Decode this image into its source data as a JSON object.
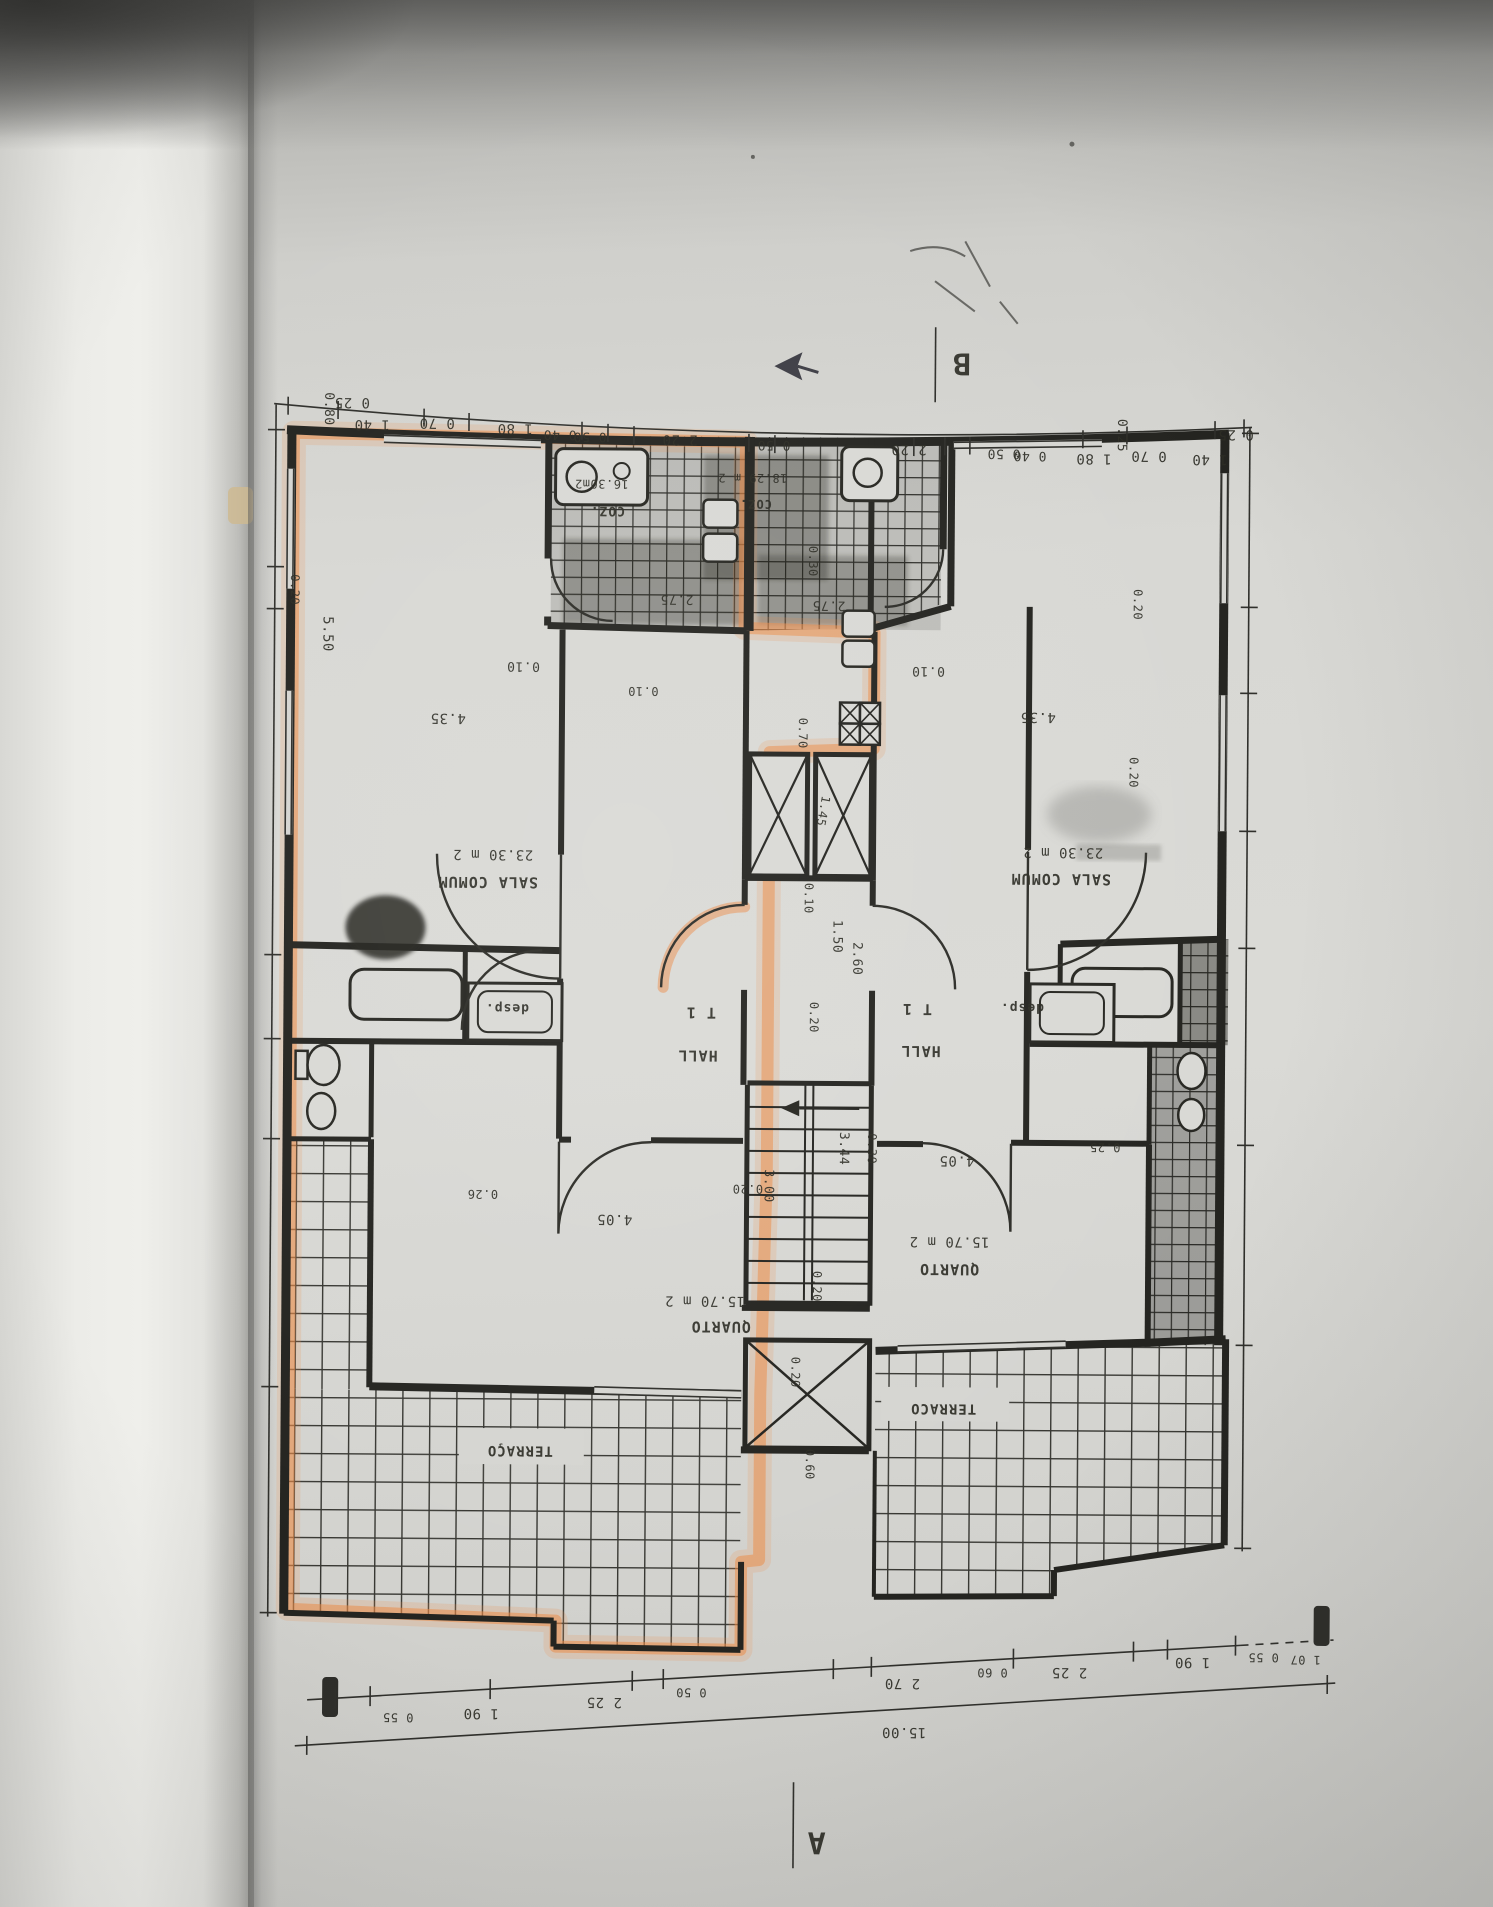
{
  "plan": {
    "section_markers": {
      "a": "A",
      "b": "B"
    },
    "highlight_color": "#ef8a43",
    "unit_left": {
      "highlighted": true,
      "type": "T 1",
      "rooms": [
        {
          "name": "SALA COMUM",
          "area": "23.30 m 2"
        },
        {
          "name": "QUARTO",
          "area": "15.70 m 2"
        },
        {
          "name": "HALL"
        },
        {
          "name": "desp."
        },
        {
          "name": "COZ.",
          "area": "16.30m2"
        },
        {
          "name": "TERRAÇO"
        }
      ]
    },
    "unit_right": {
      "highlighted": false,
      "type": "T 1",
      "rooms": [
        {
          "name": "SALA COMUM",
          "area": "23.30 m 2"
        },
        {
          "name": "QUARTO",
          "area": "15.70 m 2"
        },
        {
          "name": "HALL"
        },
        {
          "name": "desp."
        },
        {
          "name": "COZ.",
          "area": "18.29 m 2"
        },
        {
          "name": "TERRACO"
        }
      ]
    },
    "dimensions": {
      "top_chain": [
        "0 25",
        "1 40",
        "0 70",
        "1 80",
        "0 40",
        "0 50",
        "2 20",
        "0 50",
        "2 20",
        "0 50",
        "0 40",
        "1 80",
        "0 70",
        "1 40",
        "0 25"
      ],
      "bottom_chain": [
        "0 55",
        "1 90",
        "2 25",
        "0 50",
        "2 70",
        "0 60",
        "2 25",
        "1 90",
        "0 55",
        "1 07"
      ],
      "total_width": "15.00",
      "interior": [
        "4.35",
        "0.10",
        "5.50",
        "0.80",
        "0.20",
        "2.75",
        "0.30",
        "0.70",
        "1.45",
        "1.50",
        "2.60",
        "3.44",
        "3.00",
        "4.05",
        "0.26",
        "0.25",
        "0.60"
      ]
    }
  },
  "labels": [
    {
      "n": "dim-top",
      "t": "0 25",
      "x": 348,
      "y": 401,
      "s": 14
    },
    {
      "n": "dim-top",
      "t": "1 40",
      "x": 368,
      "y": 423,
      "s": 14
    },
    {
      "n": "dim-top",
      "t": "0 70",
      "x": 433,
      "y": 421,
      "s": 14
    },
    {
      "n": "dim-top",
      "t": "1 80",
      "x": 511,
      "y": 426,
      "s": 14
    },
    {
      "n": "dim-top",
      "t": "0 40",
      "x": 556,
      "y": 432,
      "s": 13
    },
    {
      "n": "dim-top",
      "t": "0 50",
      "x": 586,
      "y": 434,
      "s": 13
    },
    {
      "n": "dim-top",
      "t": "2 20",
      "x": 676,
      "y": 436,
      "s": 14
    },
    {
      "n": "dim-top",
      "t": "0 50",
      "x": 770,
      "y": 441,
      "s": 13
    },
    {
      "n": "dim-top",
      "t": "2 20",
      "x": 905,
      "y": 444,
      "s": 14
    },
    {
      "n": "dim-top",
      "t": "0 50",
      "x": 1000,
      "y": 448,
      "s": 13
    },
    {
      "n": "dim-top",
      "t": "0 40",
      "x": 1026,
      "y": 450,
      "s": 13
    },
    {
      "n": "dim-top",
      "t": "1 80",
      "x": 1090,
      "y": 452,
      "s": 14
    },
    {
      "n": "dim-top",
      "t": "0 70",
      "x": 1145,
      "y": 449,
      "s": 14
    },
    {
      "n": "dim-top",
      "t": "1 40",
      "x": 1206,
      "y": 452,
      "s": 14
    },
    {
      "n": "dim-top",
      "t": "0 25",
      "x": 1232,
      "y": 427,
      "s": 14
    },
    {
      "n": "dim-left",
      "t": "0.80",
      "x": 321,
      "y": 412,
      "s": 13,
      "r": 90
    },
    {
      "n": "dim-left",
      "t": "0.20",
      "x": 288,
      "y": 593,
      "s": 12,
      "r": 90
    },
    {
      "n": "dim-left",
      "t": "5.50",
      "x": 321,
      "y": 637,
      "s": 14,
      "r": 90
    },
    {
      "n": "dim-right",
      "t": "0.25",
      "x": 1114,
      "y": 433,
      "s": 13,
      "r": 90
    },
    {
      "n": "dim-right",
      "t": "0.20",
      "x": 1131,
      "y": 602,
      "s": 12,
      "r": 90
    },
    {
      "n": "dim-right",
      "t": "0.20",
      "x": 1128,
      "y": 770,
      "s": 12,
      "r": 90
    },
    {
      "n": "dim-core",
      "t": "0.30",
      "x": 806,
      "y": 561,
      "s": 12,
      "r": 90
    },
    {
      "n": "dim-core",
      "t": "2.75",
      "x": 674,
      "y": 596,
      "s": 13
    },
    {
      "n": "dim-core",
      "t": "2.75",
      "x": 826,
      "y": 601,
      "s": 13
    },
    {
      "n": "dim-core",
      "t": "0.10",
      "x": 521,
      "y": 664,
      "s": 13
    },
    {
      "n": "dim-core",
      "t": "0.10",
      "x": 926,
      "y": 666,
      "s": 13
    },
    {
      "n": "room-coz-left",
      "t": "COZ.",
      "x": 604,
      "y": 508,
      "s": 13,
      "b": 1
    },
    {
      "n": "area-coz-left",
      "t": "16.30m2",
      "x": 598,
      "y": 481,
      "s": 12
    },
    {
      "n": "room-coz-right",
      "t": "COZ.",
      "x": 752,
      "y": 500,
      "s": 12,
      "b": 1
    },
    {
      "n": "area-coz-right",
      "t": "18.29 m 2",
      "x": 749,
      "y": 474,
      "s": 12
    },
    {
      "n": "dim-core",
      "t": "0.10",
      "x": 641,
      "y": 688,
      "s": 12
    },
    {
      "n": "dim-core",
      "t": "0.70",
      "x": 797,
      "y": 733,
      "s": 12,
      "r": 90
    },
    {
      "n": "dim-core",
      "t": "1.45",
      "x": 818,
      "y": 810,
      "s": 12,
      "r": 100
    },
    {
      "n": "dim-core",
      "t": "0.10",
      "x": 804,
      "y": 898,
      "s": 12,
      "r": 90
    },
    {
      "n": "dim-core",
      "t": "1.50",
      "x": 833,
      "y": 936,
      "s": 13,
      "r": 90
    },
    {
      "n": "dim-core",
      "t": "0.20",
      "x": 810,
      "y": 1017,
      "s": 12,
      "r": 90
    },
    {
      "n": "dim-core",
      "t": "2.60",
      "x": 853,
      "y": 958,
      "s": 13,
      "r": 90
    },
    {
      "n": "dim-core",
      "t": "3.44",
      "x": 841,
      "y": 1148,
      "s": 13,
      "r": 90
    },
    {
      "n": "dim-core",
      "t": "3.00",
      "x": 766,
      "y": 1186,
      "s": 13,
      "r": 90
    },
    {
      "n": "dim-core",
      "t": "0.20",
      "x": 794,
      "y": 1372,
      "s": 12,
      "r": 90
    },
    {
      "n": "dim-core",
      "t": "0.60",
      "x": 809,
      "y": 1464,
      "s": 12,
      "r": 90
    },
    {
      "n": "dim-room",
      "t": "4.35",
      "x": 446,
      "y": 716,
      "s": 14
    },
    {
      "n": "area-sala-left",
      "t": "23.30 m 2",
      "x": 492,
      "y": 852,
      "s": 14
    },
    {
      "n": "room-sala-left",
      "t": "SALA COMUM",
      "x": 487,
      "y": 879,
      "s": 15,
      "b": 1
    },
    {
      "n": "dim-room",
      "t": "4.35",
      "x": 1036,
      "y": 711,
      "s": 14
    },
    {
      "n": "area-sala-right",
      "t": "23.30 m 2",
      "x": 1062,
      "y": 846,
      "s": 14
    },
    {
      "n": "room-sala-right",
      "t": "SALA COMUM",
      "x": 1060,
      "y": 872,
      "s": 15,
      "b": 1
    },
    {
      "n": "room-desp-left",
      "t": "desp.",
      "x": 507,
      "y": 1006,
      "s": 13,
      "b": 1
    },
    {
      "n": "room-desp-right",
      "t": "desp.",
      "x": 1022,
      "y": 1002,
      "s": 13,
      "b": 1
    },
    {
      "n": "type-label-left",
      "t": "T 1",
      "x": 701,
      "y": 1008,
      "s": 15,
      "b": 1
    },
    {
      "n": "type-label-right",
      "t": "T 1",
      "x": 917,
      "y": 1003,
      "s": 15,
      "b": 1
    },
    {
      "n": "room-hall-left",
      "t": "HALL",
      "x": 698,
      "y": 1051,
      "s": 15,
      "b": 1
    },
    {
      "n": "room-hall-right",
      "t": "HALL",
      "x": 921,
      "y": 1045,
      "s": 15,
      "b": 1
    },
    {
      "n": "dim-room",
      "t": "0.20",
      "x": 749,
      "y": 1185,
      "s": 12
    },
    {
      "n": "dim-room",
      "t": "0.26",
      "x": 484,
      "y": 1192,
      "s": 12
    },
    {
      "n": "dim-room",
      "t": "4.05",
      "x": 616,
      "y": 1216,
      "s": 14
    },
    {
      "n": "area-quarto-left",
      "t": "15.70 m 2",
      "x": 707,
      "y": 1297,
      "s": 14
    },
    {
      "n": "room-quarto-left",
      "t": "QUARTO",
      "x": 723,
      "y": 1322,
      "s": 15,
      "b": 1
    },
    {
      "n": "dim-room",
      "t": "0.20",
      "x": 815,
      "y": 1286,
      "s": 12,
      "r": 90
    },
    {
      "n": "dim-room",
      "t": "0.30",
      "x": 869,
      "y": 1148,
      "s": 12,
      "r": 90
    },
    {
      "n": "dim-room",
      "t": "4.05",
      "x": 958,
      "y": 1155,
      "s": 14
    },
    {
      "n": "dim-room",
      "t": "0.25",
      "x": 1106,
      "y": 1141,
      "s": 12
    },
    {
      "n": "area-quarto-right",
      "t": "15.70 m 2",
      "x": 951,
      "y": 1236,
      "s": 14
    },
    {
      "n": "room-quarto-right",
      "t": "QUARTO",
      "x": 951,
      "y": 1263,
      "s": 15,
      "b": 1
    },
    {
      "n": "room-terraco-left",
      "t": "TERRAÇO",
      "x": 523,
      "y": 1448,
      "s": 14,
      "b": 1
    },
    {
      "n": "room-terraco-right",
      "t": "TERRACO",
      "x": 946,
      "y": 1403,
      "s": 14,
      "b": 1
    },
    {
      "n": "dim-bottom",
      "t": "0 55",
      "x": 403,
      "y": 1716,
      "s": 12
    },
    {
      "n": "dim-bottom",
      "t": "1 90",
      "x": 486,
      "y": 1711,
      "s": 14
    },
    {
      "n": "dim-bottom",
      "t": "2 25",
      "x": 609,
      "y": 1699,
      "s": 14
    },
    {
      "n": "dim-bottom",
      "t": "0 50",
      "x": 696,
      "y": 1689,
      "s": 12
    },
    {
      "n": "dim-bottom",
      "t": "2 70",
      "x": 907,
      "y": 1678,
      "s": 14
    },
    {
      "n": "dim-bottom",
      "t": "0 60",
      "x": 997,
      "y": 1667,
      "s": 12
    },
    {
      "n": "dim-bottom",
      "t": "2 25",
      "x": 1074,
      "y": 1666,
      "s": 14
    },
    {
      "n": "dim-bottom",
      "t": "1 90",
      "x": 1197,
      "y": 1655,
      "s": 14
    },
    {
      "n": "dim-bottom",
      "t": "0 55",
      "x": 1268,
      "y": 1650,
      "s": 12
    },
    {
      "n": "dim-bottom",
      "t": "1 07",
      "x": 1310,
      "y": 1652,
      "s": 12
    },
    {
      "n": "dim-total-width",
      "t": "15.00",
      "x": 909,
      "y": 1727,
      "s": 14
    },
    {
      "n": "section-marker-b",
      "t": "B",
      "x": 957,
      "y": 352,
      "s": 30,
      "b": 1
    },
    {
      "n": "section-marker-a",
      "t": "A",
      "x": 822,
      "y": 1832,
      "s": 30,
      "b": 1
    }
  ]
}
